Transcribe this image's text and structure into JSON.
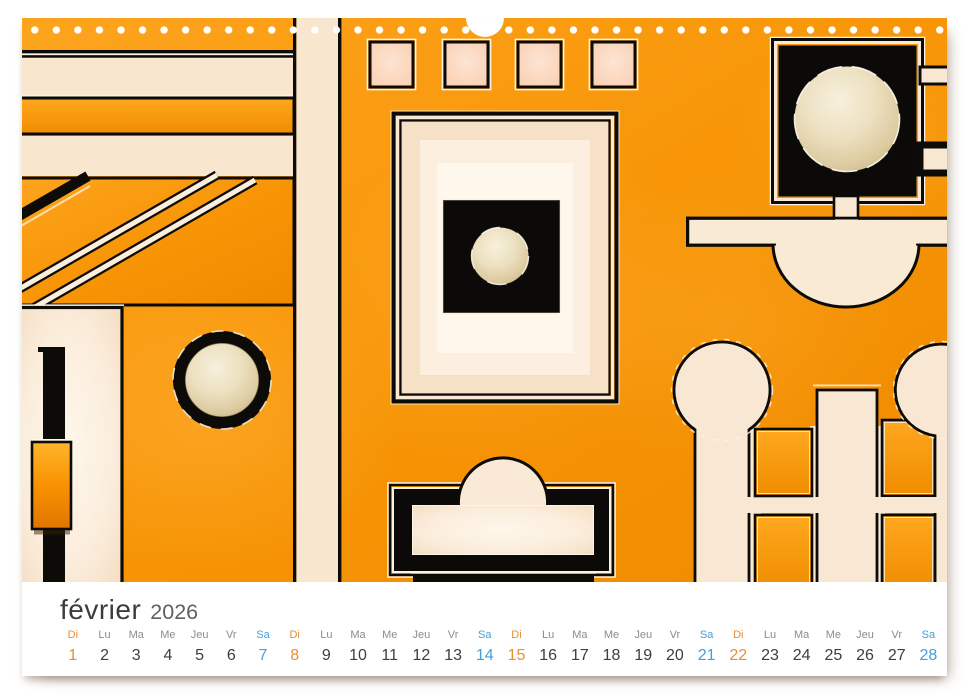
{
  "calendar": {
    "month": "février",
    "year": "2026",
    "days": [
      {
        "label": "Di",
        "num": "1",
        "type": "sun"
      },
      {
        "label": "Lu",
        "num": "2",
        "type": "week"
      },
      {
        "label": "Ma",
        "num": "3",
        "type": "week"
      },
      {
        "label": "Me",
        "num": "4",
        "type": "week"
      },
      {
        "label": "Jeu",
        "num": "5",
        "type": "week"
      },
      {
        "label": "Vr",
        "num": "6",
        "type": "week"
      },
      {
        "label": "Sa",
        "num": "7",
        "type": "sat"
      },
      {
        "label": "Di",
        "num": "8",
        "type": "sun"
      },
      {
        "label": "Lu",
        "num": "9",
        "type": "week"
      },
      {
        "label": "Ma",
        "num": "10",
        "type": "week"
      },
      {
        "label": "Me",
        "num": "11",
        "type": "week"
      },
      {
        "label": "Jeu",
        "num": "12",
        "type": "week"
      },
      {
        "label": "Vr",
        "num": "13",
        "type": "week"
      },
      {
        "label": "Sa",
        "num": "14",
        "type": "sat"
      },
      {
        "label": "Di",
        "num": "15",
        "type": "sun"
      },
      {
        "label": "Lu",
        "num": "16",
        "type": "week"
      },
      {
        "label": "Ma",
        "num": "17",
        "type": "week"
      },
      {
        "label": "Me",
        "num": "18",
        "type": "week"
      },
      {
        "label": "Jeu",
        "num": "19",
        "type": "week"
      },
      {
        "label": "Vr",
        "num": "20",
        "type": "week"
      },
      {
        "label": "Sa",
        "num": "21",
        "type": "sat"
      },
      {
        "label": "Di",
        "num": "22",
        "type": "sun"
      },
      {
        "label": "Lu",
        "num": "23",
        "type": "week"
      },
      {
        "label": "Ma",
        "num": "24",
        "type": "week"
      },
      {
        "label": "Me",
        "num": "25",
        "type": "week"
      },
      {
        "label": "Jeu",
        "num": "26",
        "type": "week"
      },
      {
        "label": "Vr",
        "num": "27",
        "type": "week"
      },
      {
        "label": "Sa",
        "num": "28",
        "type": "sat"
      }
    ]
  },
  "palette": {
    "orange": "#f79405",
    "orange_bright": "#ffa81f",
    "cream": "#f8e8d3",
    "cream_band": "#f9e6cf",
    "pink_square": "#f9ccad",
    "art_black": "#0d0b08",
    "sunday": "#e78f33",
    "saturday": "#3ea2d9",
    "weekday_gray": "#8c8c8c",
    "number_dark": "#3e3e3e",
    "title_dark": "#3c3c3c",
    "year_gray": "#5f5f5f",
    "page_white": "#ffffff"
  }
}
